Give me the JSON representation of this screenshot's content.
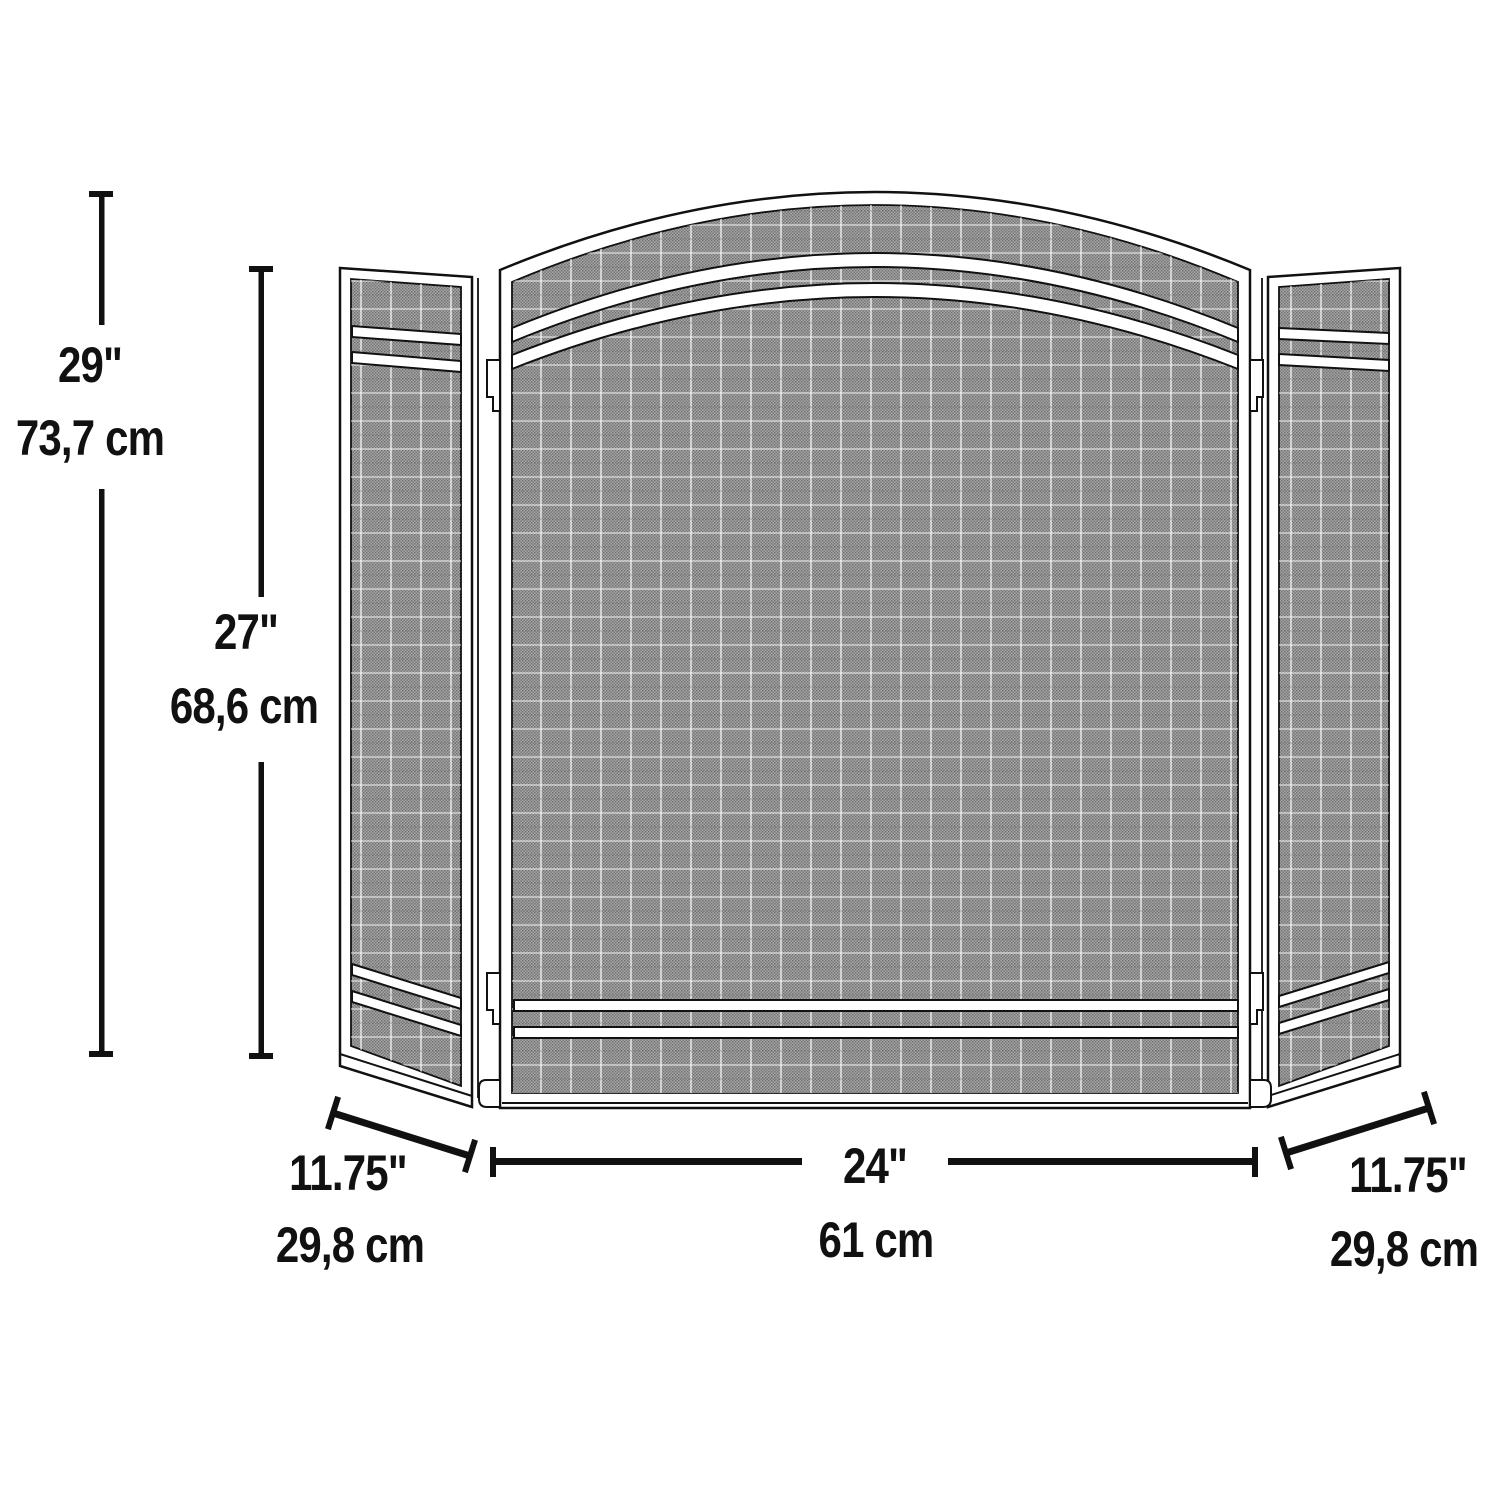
{
  "page": {
    "background": "#ffffff",
    "line_color": "#111111",
    "mesh_base_color": "#a6a6a6",
    "mesh_weave_color": "#6e6e6e"
  },
  "diagram": {
    "kind": "product-dimension-diagram",
    "subject": "three-panel-arched-fireplace-screen"
  },
  "labels": {
    "overall_height_in": "29\"",
    "overall_height_cm": "73,7 cm",
    "panel_height_in": "27\"",
    "panel_height_cm": "68,6 cm",
    "center_width_in": "24\"",
    "center_width_cm": "61 cm",
    "left_width_in": "11.75\"",
    "left_width_cm": "29,8 cm",
    "right_width_in": "11.75\"",
    "right_width_cm": "29,8 cm"
  }
}
